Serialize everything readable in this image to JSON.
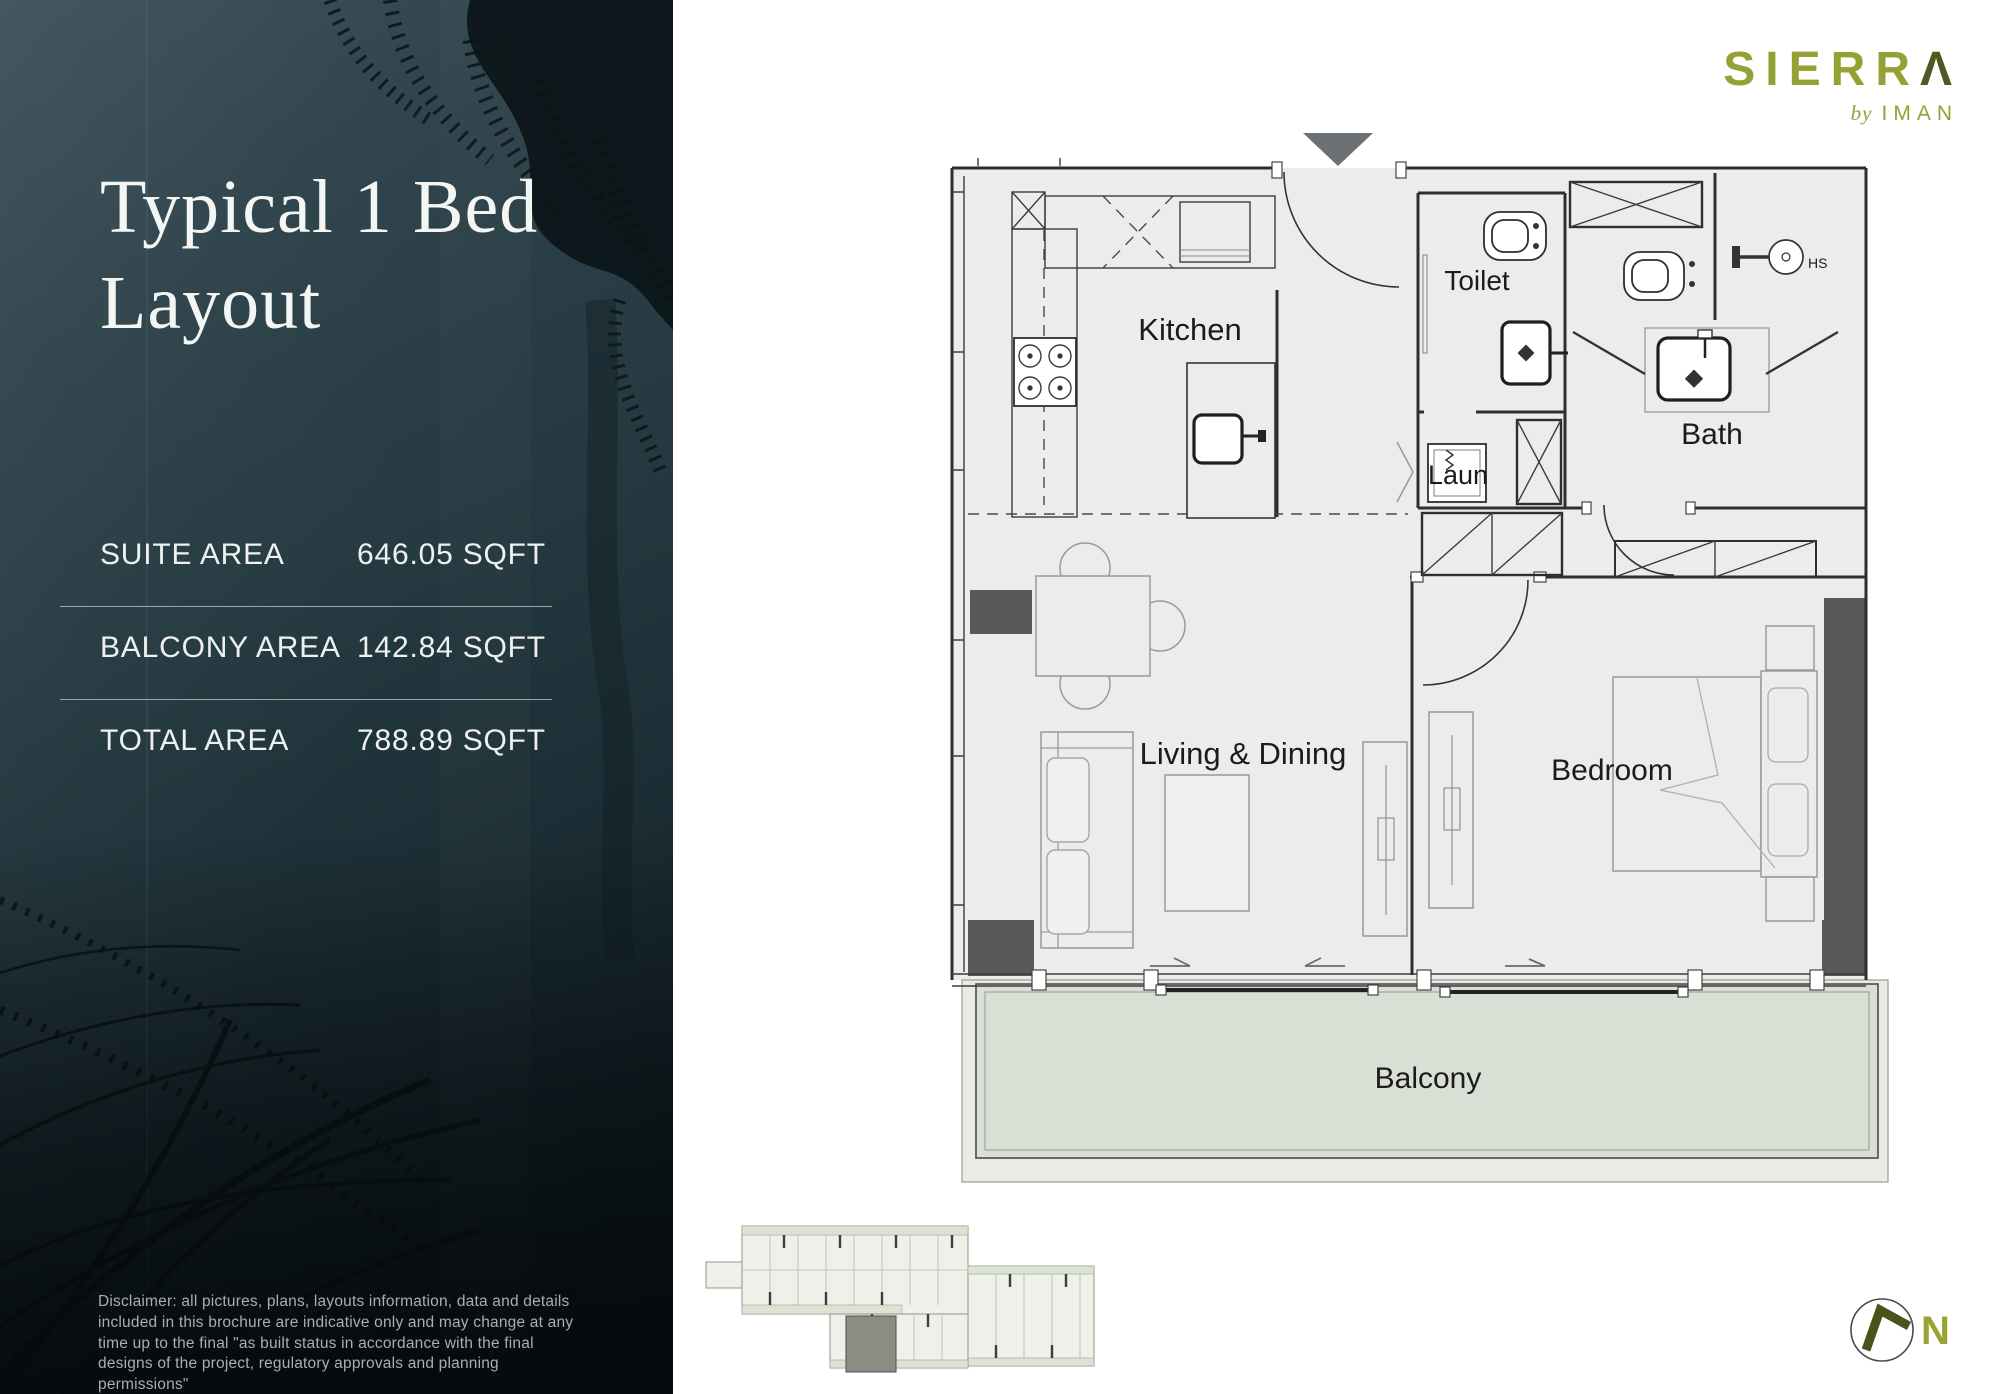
{
  "brand": {
    "name_prefix": "SIERR",
    "name_last": "Λ",
    "full_name": "SIERRA",
    "byline_by": "by",
    "byline_name": "IMAN"
  },
  "sidebar": {
    "title_line1": "Typical 1 Bed",
    "title_line2": "Layout",
    "stats": [
      {
        "label": "SUITE AREA",
        "value": "646.05 SQFT"
      },
      {
        "label": "BALCONY AREA",
        "value": "142.84 SQFT"
      },
      {
        "label": "TOTAL AREA",
        "value": "788.89 SQFT"
      }
    ],
    "disclaimer": "Disclaimer: all pictures, plans, layouts information, data and details included in this brochure are indicative only and may change at any time up to the final \"as built status in accordance with the final designs of the project, regulatory approvals and planning permissions\""
  },
  "plan": {
    "labels": {
      "kitchen": "Kitchen",
      "toilet": "Toilet",
      "bath": "Bath",
      "laundry": "Laun",
      "living": "Living & Dining",
      "bedroom": "Bedroom",
      "balcony": "Balcony",
      "shower": "HS"
    }
  },
  "compass": {
    "north": "N"
  },
  "colors": {
    "logo_olive": "#96a135",
    "logo_dark_olive": "#4f5820",
    "panel_teal": "#24383f",
    "balcony_fill": "#d9dfd4",
    "plan_floor": "#ecedeb",
    "column_gray": "#57585a"
  }
}
